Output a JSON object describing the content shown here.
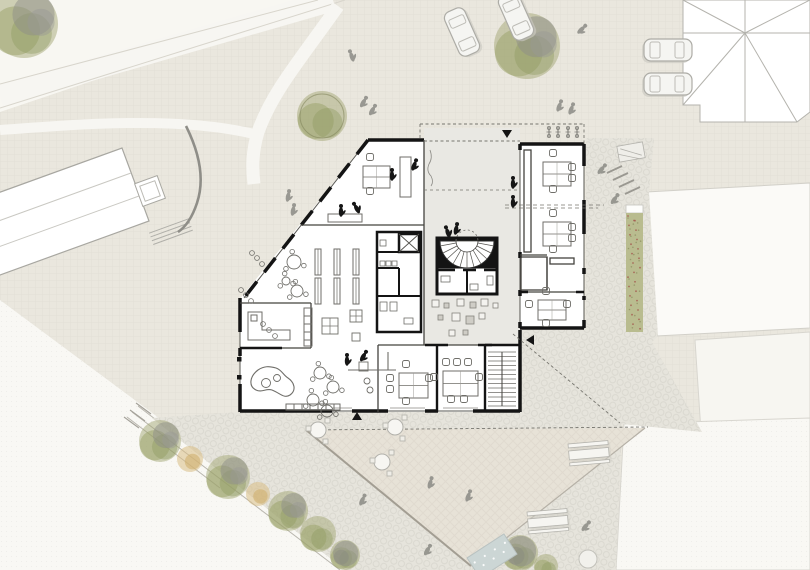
{
  "meta": {
    "type": "architectural-site-plan",
    "floor": "ground-floor",
    "visible_text": []
  },
  "palette": {
    "base": "#eae7de",
    "white_field": "#f9f8f4",
    "cobble": "#e6e4dc",
    "plaza": "#e7e2d7",
    "courtyard": "#e9e8e3",
    "building": "#ffffff",
    "wall": "#141414",
    "line": "#6f6e69",
    "light_line": "#b2b1ab",
    "path_white": "#f7f6f2",
    "tree_green": "#a3a876",
    "tree_gray": "#8e8e88",
    "shrub_tan": "#d9bd85",
    "planting": "#b9bc8f",
    "flowers": "#a4584d",
    "water": "#ccd6d5",
    "car": "#f5f5f2",
    "figure_gray": "#8b8b85",
    "figure_black": "#161616"
  },
  "site": {
    "trees": [
      {
        "x": 24,
        "y": 24,
        "r": 34,
        "v": "green-gray"
      },
      {
        "x": 322,
        "y": 116,
        "r": 25,
        "v": "green-outline"
      },
      {
        "x": 527,
        "y": 46,
        "r": 33,
        "v": "green-gray"
      },
      {
        "x": 160,
        "y": 441,
        "r": 21,
        "v": "green-gray"
      },
      {
        "x": 190,
        "y": 459,
        "r": 13,
        "v": "tan"
      },
      {
        "x": 228,
        "y": 477,
        "r": 22,
        "v": "green-gray"
      },
      {
        "x": 258,
        "y": 494,
        "r": 12,
        "v": "tan"
      },
      {
        "x": 288,
        "y": 511,
        "r": 20,
        "v": "green-gray"
      },
      {
        "x": 318,
        "y": 534,
        "r": 18,
        "v": "green"
      },
      {
        "x": 345,
        "y": 555,
        "r": 15,
        "v": "gray-green"
      },
      {
        "x": 520,
        "y": 553,
        "r": 18,
        "v": "gray-green"
      },
      {
        "x": 546,
        "y": 566,
        "r": 12,
        "v": "green"
      }
    ],
    "people": [
      {
        "x": 352,
        "y": 57,
        "rot": -20,
        "c": "gray"
      },
      {
        "x": 363,
        "y": 103,
        "rot": 30,
        "c": "gray"
      },
      {
        "x": 372,
        "y": 111,
        "rot": 30,
        "c": "gray"
      },
      {
        "x": 581,
        "y": 30,
        "rot": 45,
        "c": "gray"
      },
      {
        "x": 559,
        "y": 107,
        "rot": 20,
        "c": "gray"
      },
      {
        "x": 571,
        "y": 110,
        "rot": 20,
        "c": "gray"
      },
      {
        "x": 601,
        "y": 170,
        "rot": 40,
        "c": "gray"
      },
      {
        "x": 614,
        "y": 200,
        "rot": 35,
        "c": "gray"
      },
      {
        "x": 288,
        "y": 197,
        "rot": 10,
        "c": "gray"
      },
      {
        "x": 293,
        "y": 211,
        "rot": 10,
        "c": "gray"
      },
      {
        "x": 430,
        "y": 484,
        "rot": 15,
        "c": "gray"
      },
      {
        "x": 468,
        "y": 497,
        "rot": 20,
        "c": "gray"
      },
      {
        "x": 362,
        "y": 501,
        "rot": 25,
        "c": "gray"
      },
      {
        "x": 427,
        "y": 551,
        "rot": 30,
        "c": "gray"
      },
      {
        "x": 585,
        "y": 527,
        "rot": 40,
        "c": "gray"
      },
      {
        "x": 341,
        "y": 212,
        "rot": 0,
        "c": "black"
      },
      {
        "x": 357,
        "y": 209,
        "rot": -30,
        "c": "black"
      },
      {
        "x": 392,
        "y": 176,
        "rot": 0,
        "c": "black"
      },
      {
        "x": 414,
        "y": 166,
        "rot": 20,
        "c": "black"
      },
      {
        "x": 513,
        "y": 184,
        "rot": 0,
        "c": "black"
      },
      {
        "x": 513,
        "y": 203,
        "rot": 0,
        "c": "black"
      },
      {
        "x": 448,
        "y": 233,
        "rot": -20,
        "c": "black"
      },
      {
        "x": 456,
        "y": 230,
        "rot": 10,
        "c": "black"
      },
      {
        "x": 347,
        "y": 361,
        "rot": 0,
        "c": "black"
      },
      {
        "x": 363,
        "y": 357,
        "rot": 30,
        "c": "black"
      }
    ],
    "cars": [
      {
        "x": 462,
        "y": 32,
        "rot": -24
      },
      {
        "x": 516,
        "y": 16,
        "rot": -24
      },
      {
        "x": 668,
        "y": 50,
        "rot": 90
      },
      {
        "x": 668,
        "y": 84,
        "rot": 90
      }
    ],
    "benches": [
      {
        "x": 568,
        "y": 444,
        "rot": -5
      },
      {
        "x": 527,
        "y": 512,
        "rot": -5
      }
    ],
    "bikes": [
      {
        "x": 549,
        "y": 127
      },
      {
        "x": 558,
        "y": 127
      },
      {
        "x": 568,
        "y": 127
      },
      {
        "x": 577,
        "y": 127
      }
    ],
    "outdoor_tables": [
      {
        "x": 318,
        "y": 430
      },
      {
        "x": 395,
        "y": 427
      },
      {
        "x": 382,
        "y": 462
      }
    ],
    "round_table": {
      "x": 588,
      "y": 559,
      "r": 9
    },
    "water_feature": {
      "x": 492,
      "y": 556,
      "w": 44,
      "h": 24,
      "rot": -33
    },
    "flower_strip": {
      "x": 626,
      "y": 213,
      "w": 17,
      "h": 119,
      "flower_count": 26
    }
  },
  "building": {
    "entrances": [
      {
        "x": 507,
        "y": 133,
        "dir": "down"
      },
      {
        "x": 531,
        "y": 340,
        "dir": "left"
      },
      {
        "x": 357,
        "y": 417,
        "dir": "up"
      }
    ],
    "furniture": {
      "shelves": [
        {
          "x": 315,
          "y": 249
        },
        {
          "x": 334,
          "y": 249
        },
        {
          "x": 353,
          "y": 249
        },
        {
          "x": 315,
          "y": 278
        },
        {
          "x": 334,
          "y": 278
        },
        {
          "x": 353,
          "y": 278
        }
      ],
      "desk_groups": [
        {
          "x": 543,
          "y": 162,
          "w": 28,
          "h": 24,
          "chairs": [
            [
              10,
              -9
            ],
            [
              29,
              5
            ],
            [
              29,
              16
            ],
            [
              10,
              27
            ]
          ]
        },
        {
          "x": 543,
          "y": 222,
          "w": 28,
          "h": 24,
          "chairs": [
            [
              10,
              -9
            ],
            [
              29,
              5
            ],
            [
              29,
              16
            ],
            [
              10,
              27
            ]
          ]
        },
        {
          "x": 538,
          "y": 300,
          "w": 28,
          "h": 20,
          "chairs": [
            [
              8,
              -9
            ],
            [
              -9,
              4
            ],
            [
              29,
              4
            ],
            [
              8,
              23
            ]
          ]
        },
        {
          "x": 363,
          "y": 166,
          "w": 27,
          "h": 22,
          "chairs": [
            [
              7,
              -9
            ],
            [
              7,
              25
            ]
          ]
        },
        {
          "x": 399,
          "y": 373,
          "w": 29,
          "h": 25,
          "chairs": [
            [
              7,
              -9
            ],
            [
              -9,
              5
            ],
            [
              -9,
              16
            ],
            [
              30,
              5
            ],
            [
              7,
              28
            ]
          ]
        },
        {
          "x": 443,
          "y": 371,
          "w": 35,
          "h": 25,
          "chairs": [
            [
              3,
              -9
            ],
            [
              14,
              -9
            ],
            [
              25,
              -9
            ],
            [
              -9,
              6
            ],
            [
              36,
              6
            ],
            [
              8,
              28
            ],
            [
              21,
              28
            ]
          ]
        }
      ],
      "round_tables": [
        {
          "x": 294,
          "y": 262,
          "r": 7
        },
        {
          "x": 297,
          "y": 291,
          "r": 6
        },
        {
          "x": 286,
          "y": 281,
          "r": 4
        },
        {
          "x": 320,
          "y": 373,
          "r": 6
        },
        {
          "x": 333,
          "y": 387,
          "r": 6
        },
        {
          "x": 313,
          "y": 400,
          "r": 6
        },
        {
          "x": 327,
          "y": 411,
          "r": 6
        }
      ],
      "seat_cubes": [
        {
          "x": 432,
          "y": 300,
          "s": 7
        },
        {
          "x": 444,
          "y": 303,
          "s": 5,
          "f": 1
        },
        {
          "x": 457,
          "y": 299,
          "s": 7
        },
        {
          "x": 470,
          "y": 302,
          "s": 6,
          "f": 1
        },
        {
          "x": 481,
          "y": 299,
          "s": 7
        },
        {
          "x": 493,
          "y": 303,
          "s": 5
        },
        {
          "x": 438,
          "y": 315,
          "s": 5,
          "f": 1
        },
        {
          "x": 452,
          "y": 313,
          "s": 8
        },
        {
          "x": 466,
          "y": 316,
          "s": 8,
          "f": 1
        },
        {
          "x": 479,
          "y": 313,
          "s": 6
        },
        {
          "x": 449,
          "y": 330,
          "s": 6
        },
        {
          "x": 463,
          "y": 330,
          "s": 5,
          "f": 1
        }
      ],
      "grid_tables": [
        {
          "x": 322,
          "y": 318,
          "s": 16,
          "cross": true
        },
        {
          "x": 350,
          "y": 310,
          "s": 12,
          "cross": true
        },
        {
          "x": 352,
          "y": 333,
          "s": 8
        },
        {
          "x": 359,
          "y": 362,
          "s": 9
        }
      ],
      "wall_chairs": [
        {
          "x": 252,
          "y": 253
        },
        {
          "x": 257,
          "y": 258
        },
        {
          "x": 262,
          "y": 264
        },
        {
          "x": 241,
          "y": 290
        },
        {
          "x": 246,
          "y": 295
        },
        {
          "x": 251,
          "y": 301
        },
        {
          "x": 263,
          "y": 324
        },
        {
          "x": 269,
          "y": 330
        },
        {
          "x": 275,
          "y": 336
        }
      ]
    }
  }
}
